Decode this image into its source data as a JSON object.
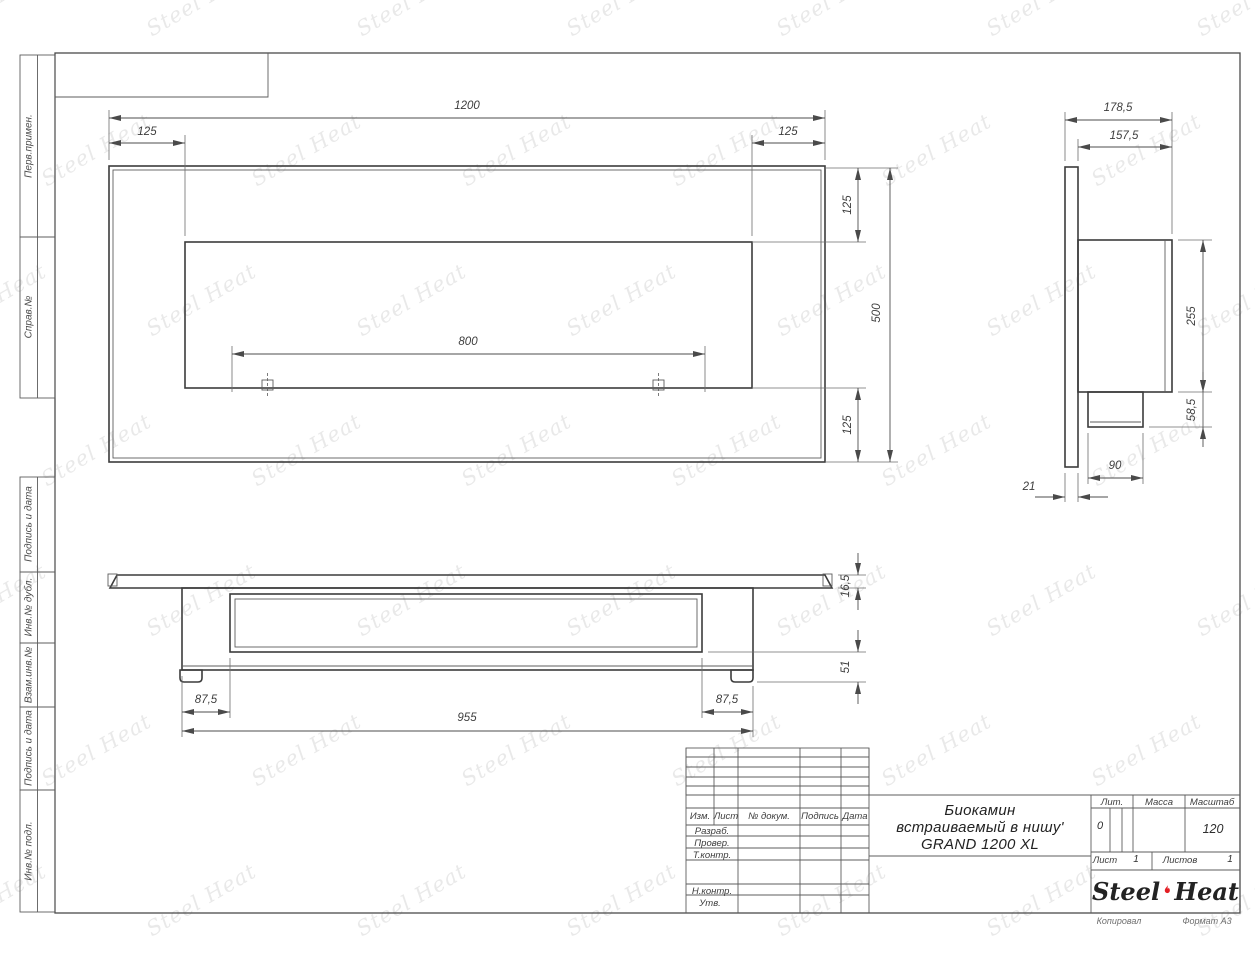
{
  "watermark": {
    "text": "Steel Heat"
  },
  "sheet_notes": {
    "copied": "Копировал",
    "format": "Формат А3"
  },
  "side_labels": {
    "perv_primen": "Перв.примен.",
    "sprav_no": "Справ.№",
    "podpis_data_1": "Подпись и дата",
    "inv_dubl": "Инв.№ дубл.",
    "vzam_inv": "Взам.инв.№",
    "podpis_data_2": "Подпись и дата",
    "inv_podl": "Инв.№ подл."
  },
  "title_block": {
    "doc_title_line1": "Биокамин",
    "doc_title_line2": "встраиваемый в нишу'",
    "doc_title_line3": "GRAND 1200 XL",
    "col_izm": "Изм.",
    "col_list": "Лист",
    "col_doc": "№ докум.",
    "col_sign": "Подпись",
    "col_date": "Дата",
    "row_developed": "Разраб.",
    "row_checked": "Провер.",
    "row_tcontrol": "Т.контр.",
    "row_ncontrol": "Н.контр.",
    "row_approved": "Утв.",
    "lit_label": "Лит.",
    "lit_value": "0",
    "mass_label": "Масса",
    "scale_label": "Масштаб",
    "scale_value": "120",
    "sheet_label": "Лист",
    "sheet_value": "1",
    "sheets_label": "Листов",
    "sheets_value": "1",
    "brand": {
      "steel": "Steel",
      "heat": "Heat",
      "flame_color": "#e31e24"
    }
  },
  "dimensions": {
    "front": {
      "overall_width": "1200",
      "left_inset": "125",
      "right_inset": "125",
      "burner_length": "800",
      "top_inset": "125",
      "overall_height": "500",
      "bottom_inset": "125"
    },
    "side": {
      "total_depth": "178,5",
      "body_depth": "157,5",
      "body_height": "255",
      "tray_height": "58,5",
      "tray_depth": "90",
      "flange_thickness": "21"
    },
    "top": {
      "flange_thickness": "16,5",
      "body_height": "51",
      "left_margin": "87,5",
      "right_margin": "87,5",
      "body_length": "955"
    }
  }
}
